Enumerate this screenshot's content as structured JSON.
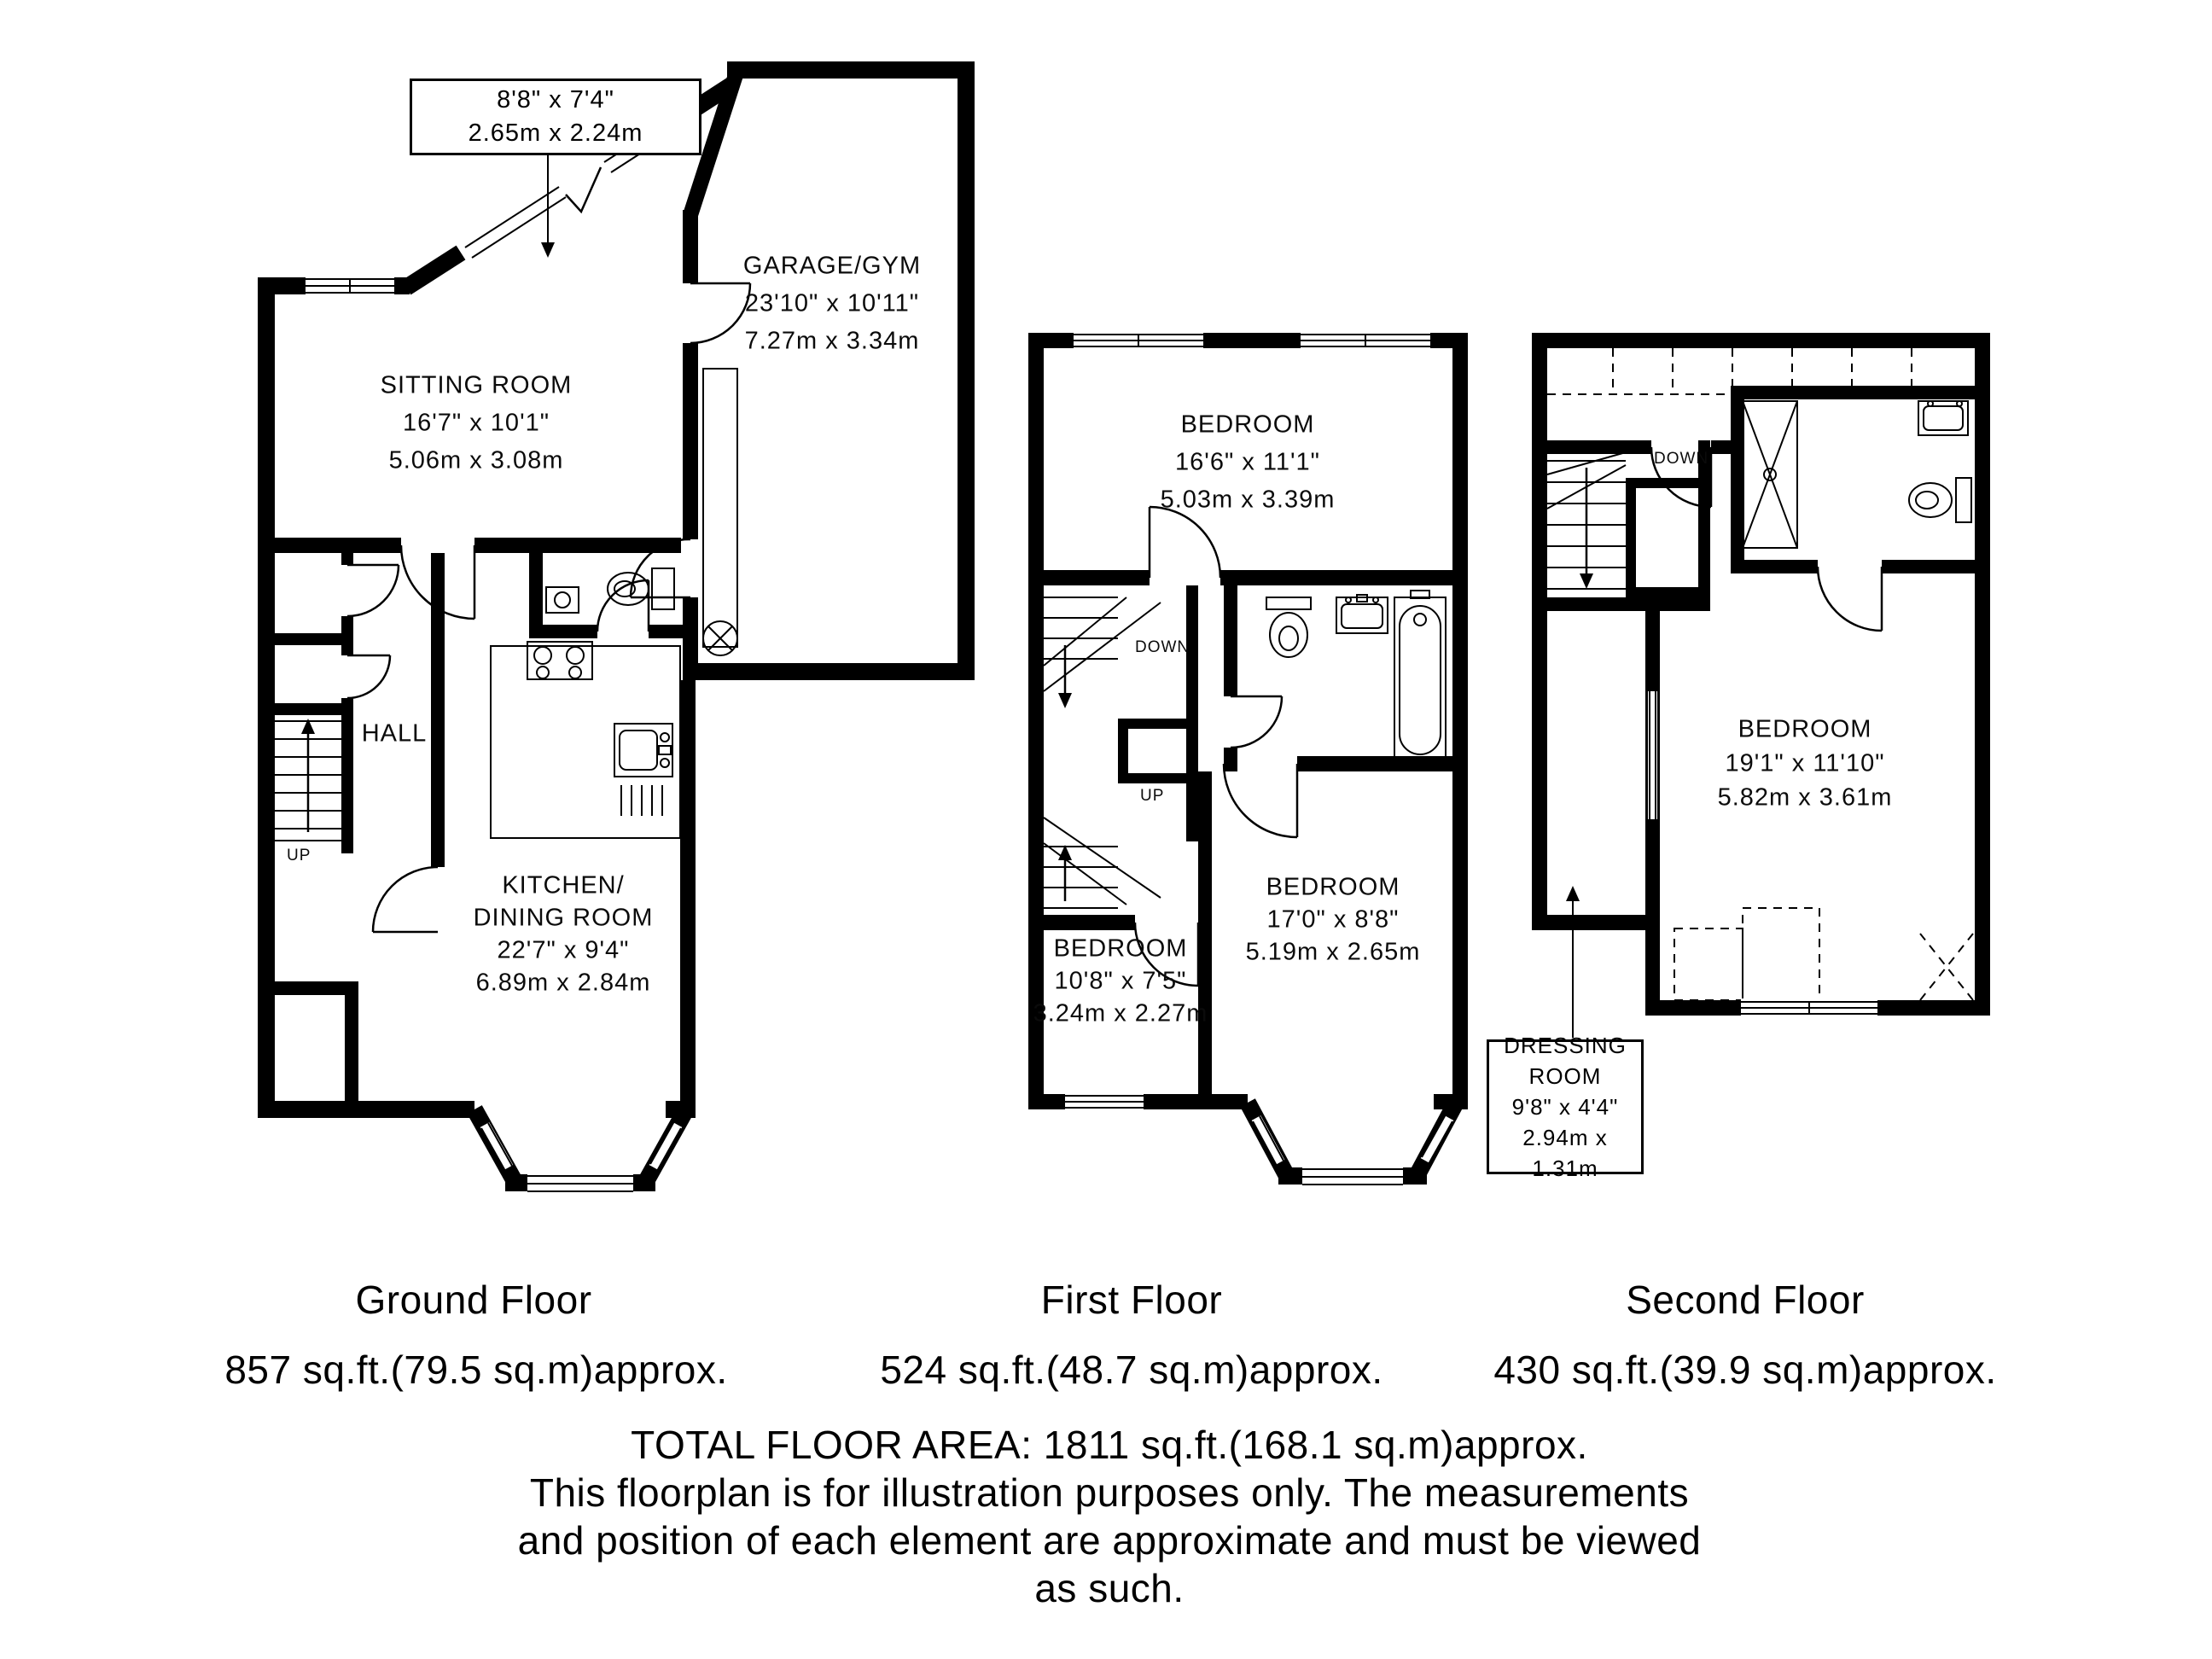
{
  "floors": {
    "ground": {
      "caption_title": "Ground Floor",
      "caption_area": "857 sq.ft.(79.5 sq.m)approx.",
      "porch_callout": {
        "imperial": "8'8\" x 7'4\"",
        "metric": "2.65m x 2.24m"
      },
      "sitting_room": {
        "name": "SITTING ROOM",
        "imperial": "16'7\" x 10'1\"",
        "metric": "5.06m x 3.08m"
      },
      "garage": {
        "name": "GARAGE/GYM",
        "imperial": "23'10\" x 10'11\"",
        "metric": "7.27m x 3.34m"
      },
      "hall": {
        "name": "HALL"
      },
      "kitchen": {
        "name_line1": "KITCHEN/",
        "name_line2": "DINING ROOM",
        "imperial": "22'7\" x 9'4\"",
        "metric": "6.89m x 2.84m"
      },
      "stair_up_label": "UP"
    },
    "first": {
      "caption_title": "First Floor",
      "caption_area": "524 sq.ft.(48.7 sq.m)approx.",
      "bedroom_top": {
        "name": "BEDROOM",
        "imperial": "16'6\" x 11'1\"",
        "metric": "5.03m x 3.39m"
      },
      "bedroom_left": {
        "name": "BEDROOM",
        "imperial": "10'8\" x 7'5\"",
        "metric": "3.24m x 2.27m"
      },
      "bedroom_right": {
        "name": "BEDROOM",
        "imperial": "17'0\" x 8'8\"",
        "metric": "5.19m x 2.65m"
      },
      "stair_down_label": "DOWN",
      "stair_up_label": "UP"
    },
    "second": {
      "caption_title": "Second Floor",
      "caption_area": "430 sq.ft.(39.9 sq.m)approx.",
      "bedroom": {
        "name": "BEDROOM",
        "imperial": "19'1\" x 11'10\"",
        "metric": "5.82m x 3.61m"
      },
      "dressing_callout": {
        "name_line1": "DRESSING",
        "name_line2": "ROOM",
        "imperial": "9'8\" x 4'4\"",
        "metric": "2.94m x 1.31m"
      },
      "stair_down_label": "DOWN"
    }
  },
  "footer": {
    "total": "TOTAL FLOOR AREA: 1811 sq.ft.(168.1 sq.m)approx.",
    "disclaimer_line1": "This floorplan is for illustration purposes only. The measurements",
    "disclaimer_line2": "and position of each element are approximate and must be viewed",
    "disclaimer_line3": "as such."
  }
}
